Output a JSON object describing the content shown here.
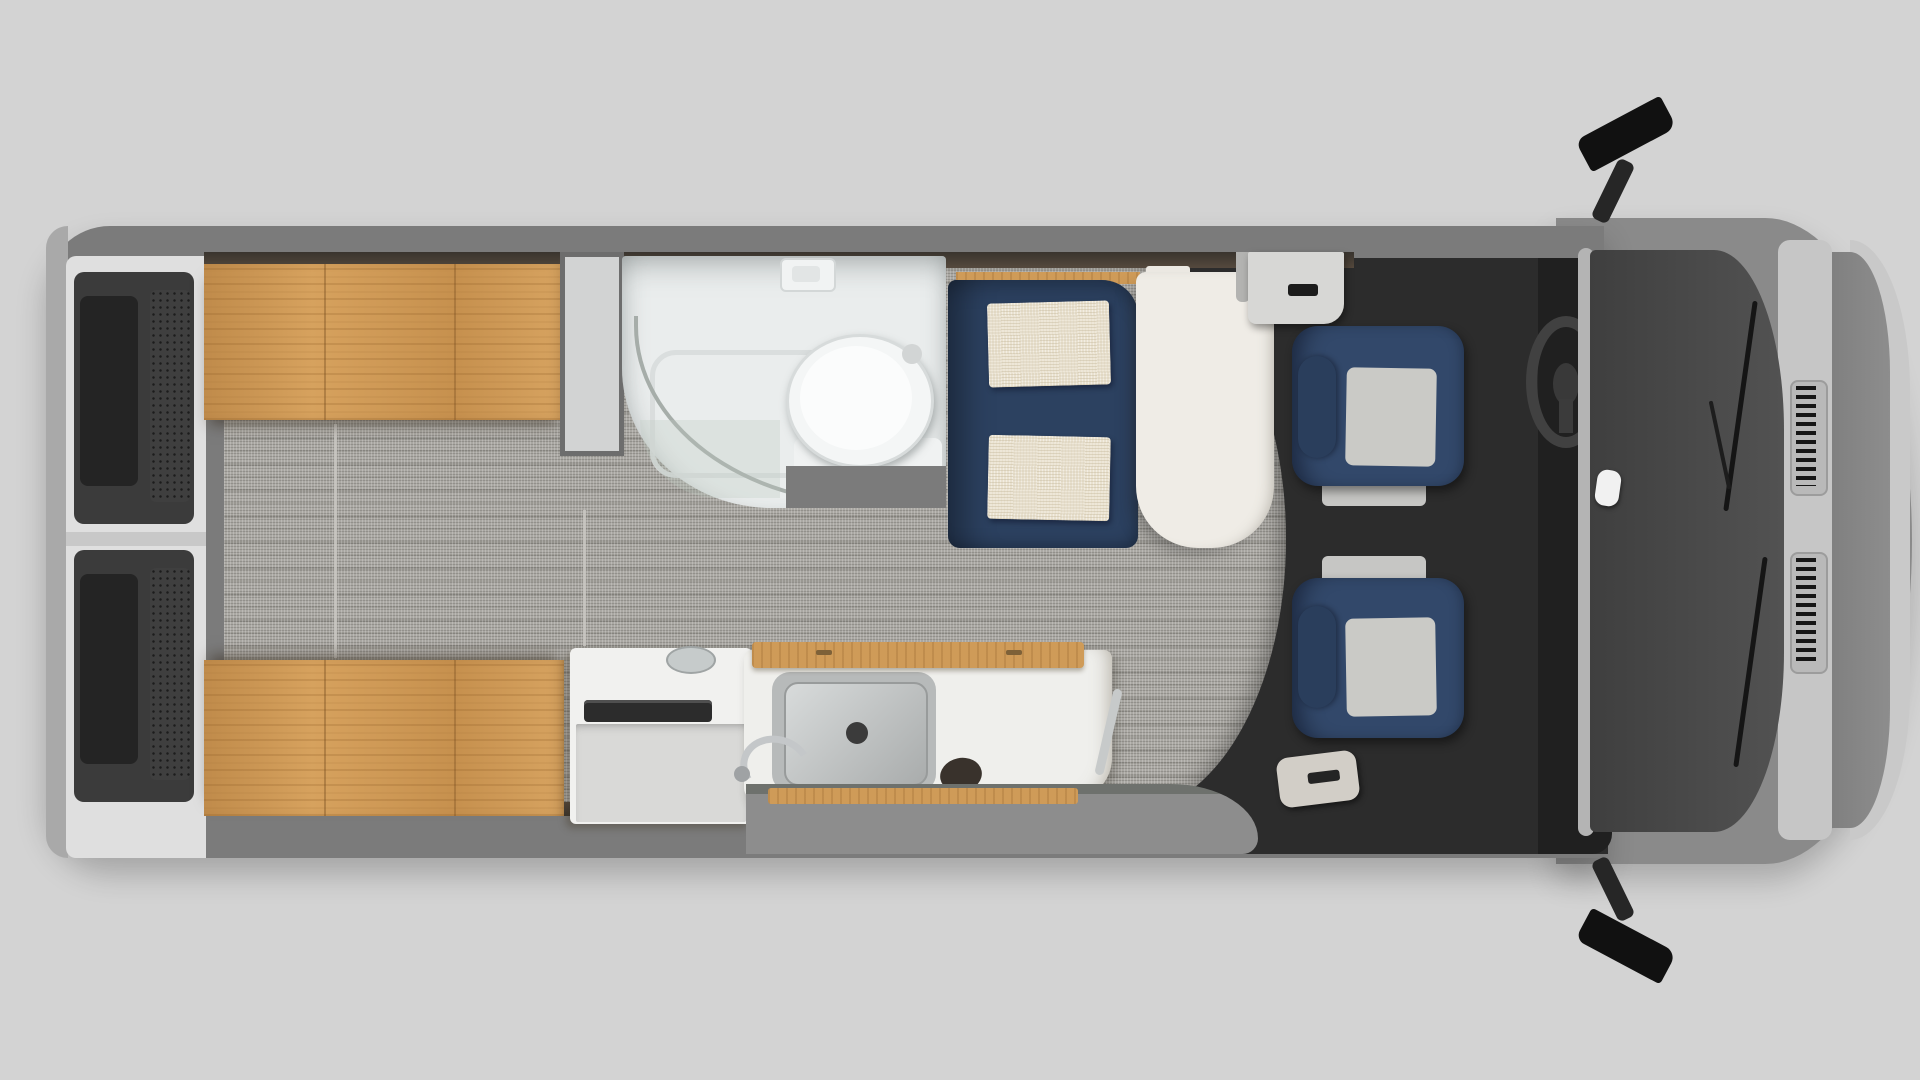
{
  "scene": {
    "subject": "top-down floor plan rendering of a camper van interior",
    "orientation": "van front at right, rear doors at left",
    "background": "#d3d3d3"
  },
  "colors": {
    "body_wall": "#7b7b7b",
    "rear_bumper": "#a9a9a9",
    "front_fender": "#8a8a8a",
    "front_edge_highlight": "#c9c9c9",
    "carpet_floor": "#a3a19b",
    "bed_wood": "#d29a54",
    "counter_wood": "#cf9b58",
    "bathroom_white": "#eaeded",
    "toilet_white": "#f4f6f6",
    "wardrobe_gray": "#d2d3d3",
    "sofa_navy": "#2c4160",
    "cushion_cream": "#e9e1cf",
    "table_white": "#efece6",
    "seat_navy": "#32486a",
    "seat_insert_gray": "#cacac6",
    "cab_floor_dark": "#2c2c2c",
    "dashboard_dark": "#202020",
    "steering_wheel": "#414141",
    "windshield_glass": "#474747",
    "cowl_silver": "#c6c6c6",
    "hood_gray": "#868686",
    "mirror_black": "#111111",
    "entry_step_gray": "#8d8d8d",
    "galley_white": "#efefec",
    "sink_steel": "#c2c5c5",
    "stove_knob_dark": "#39322c",
    "door_card_dark": "#3b3b3b"
  },
  "regions": {
    "rear": [
      "rear-bumper",
      "rear-doors"
    ],
    "bedroom": [
      "bed-top",
      "bed-bottom",
      "aisle-carpet",
      "floor-track-rails"
    ],
    "wet_bath": [
      "wardrobe",
      "shower-enclosure",
      "shower-glass-door",
      "toilet",
      "shower-bracket"
    ],
    "lounge": [
      "sofa",
      "sofa-cushions",
      "pedestal-table"
    ],
    "kitchen": [
      "cooktop-cabinet",
      "galley-cabinet",
      "sink",
      "faucet",
      "stove-knob",
      "counter-flap"
    ],
    "cab": [
      "passenger-seat",
      "driver-seat",
      "steering-wheel",
      "dashboard",
      "b-pillar-trim",
      "grab-handle",
      "entry-step",
      "console"
    ],
    "front": [
      "windshield",
      "wipers",
      "cowl-vents",
      "hood",
      "side-mirror-top",
      "side-mirror-bottom"
    ]
  }
}
